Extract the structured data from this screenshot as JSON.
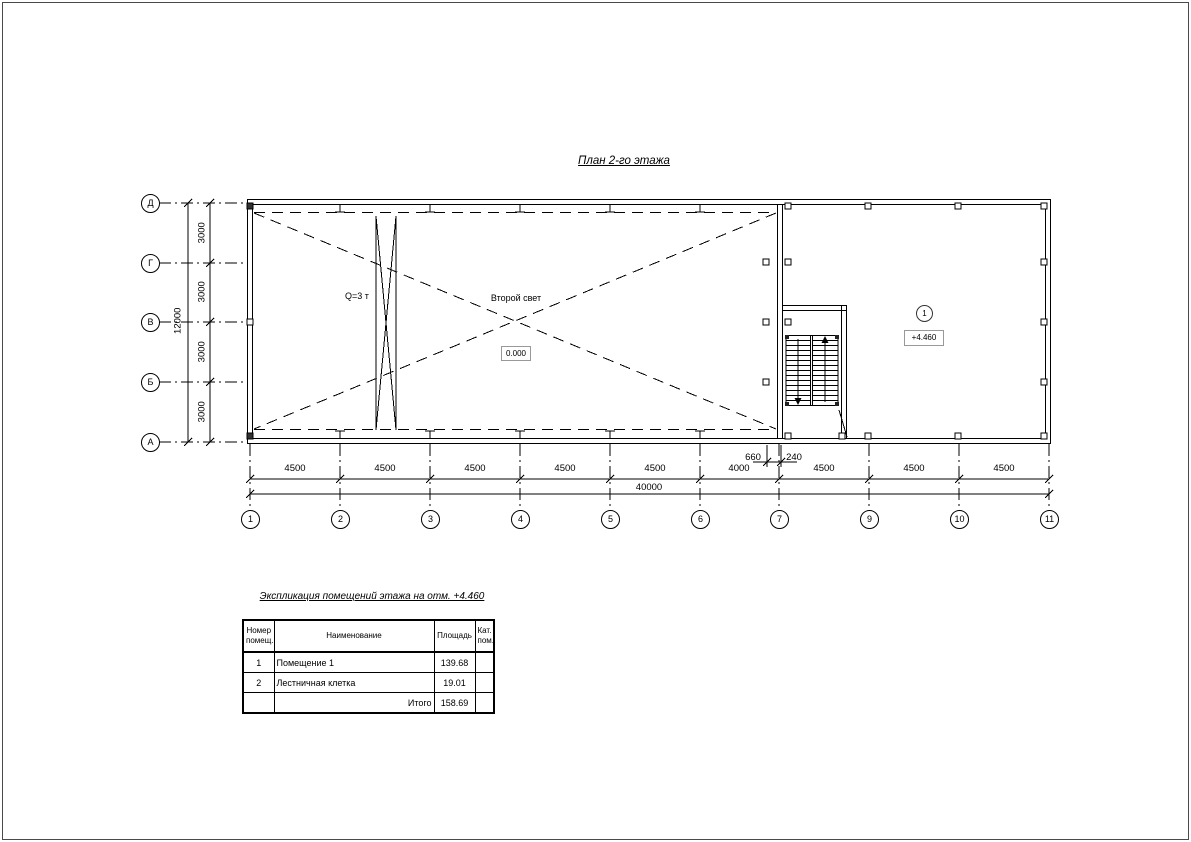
{
  "title": "План 2-го этажа",
  "plan": {
    "crane_label": "Q=3 т",
    "void_label": "Второй свет",
    "elev_zero": "0.000",
    "elev_floor": "+4.460",
    "room_tag": "1",
    "grid_cols": [
      "1",
      "2",
      "3",
      "4",
      "5",
      "6",
      "7",
      "9",
      "10",
      "11"
    ],
    "grid_rows": [
      "Д",
      "Г",
      "В",
      "Б",
      "А"
    ],
    "dim_col_segments": [
      "4500",
      "4500",
      "4500",
      "4500",
      "4500",
      "4000",
      "4500",
      "4500",
      "4500"
    ],
    "dim_col_total": "40000",
    "dim_row_segments": [
      "3000",
      "3000",
      "3000",
      "3000"
    ],
    "dim_row_total": "12000",
    "dim_door_left": "660",
    "dim_door_right": "240"
  },
  "exp_table": {
    "title": "Экспликация помещений этажа на отм. +4.460",
    "col_num": "Номер\nпомещ.",
    "col_name": "Наименование",
    "col_area": "Площадь",
    "col_cat": "Кат.\nпом.",
    "rows": [
      {
        "num": "1",
        "name": "Помещение 1",
        "area": "139.68",
        "cat": ""
      },
      {
        "num": "2",
        "name": "Лестничная клетка",
        "area": "19.01",
        "cat": ""
      }
    ],
    "total_label": "Итого",
    "total_area": "158.69"
  }
}
